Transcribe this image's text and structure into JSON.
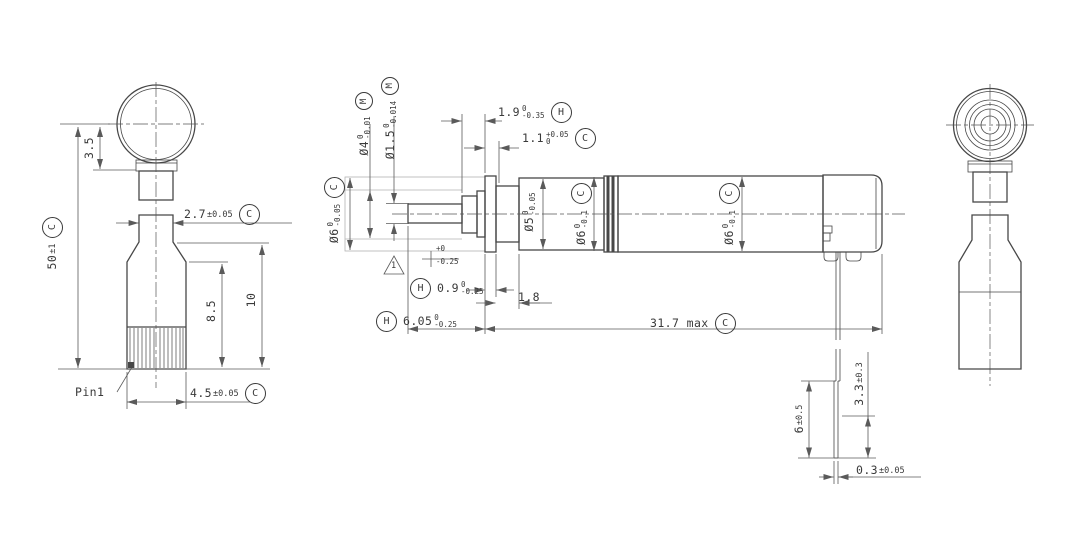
{
  "left": {
    "pin": "Pin1",
    "d35": {
      "m": "3.5"
    },
    "d50": {
      "m": "50",
      "t": "±1",
      "dt": "C"
    },
    "d27": {
      "m": "2.7",
      "t": "±0.05",
      "dt": "C"
    },
    "d85": {
      "m": "8.5"
    },
    "d10": {
      "m": "10"
    },
    "d45": {
      "m": "4.5",
      "t": "±0.05",
      "dt": "C"
    }
  },
  "front": {
    "dia6s": {
      "m": "Ø6",
      "tu": "0",
      "td": "-0.05",
      "dt": "C"
    },
    "dia4": {
      "m": "Ø4",
      "tu": "0",
      "td": "-0.01",
      "dt": "M"
    },
    "dia15": {
      "m": "Ø1.5",
      "tu": "0",
      "td": "-0.014",
      "dt": "M"
    },
    "d19": {
      "m": "1.9",
      "tu": "0",
      "td": "-0.35",
      "dt": "H"
    },
    "d11": {
      "m": "1.1",
      "tu": "+0.05",
      "td": "0",
      "dt": "C"
    },
    "dia5": {
      "m": "Ø5",
      "tu": "0",
      "td": "-0.05"
    },
    "dia6a": {
      "m": "Ø6",
      "tu": "0",
      "td": "-0.1",
      "dt": "C"
    },
    "dia6b": {
      "m": "Ø6",
      "tu": "0",
      "td": "-0.1",
      "dt": "C"
    },
    "d09": {
      "m": "0.9",
      "tu": "0",
      "td": "-0.25",
      "dt": "H"
    },
    "callout": {
      "tu": "+0",
      "td": "-0.25"
    },
    "flag": "1",
    "d18": {
      "m": "1.8"
    },
    "d605": {
      "m": "6.05",
      "tu": "0",
      "td": "-0.25",
      "dt": "H"
    },
    "d317": {
      "m": "31.7 max",
      "dt": "C"
    },
    "d33": {
      "m": "3.3",
      "t": "±0.3"
    },
    "d6": {
      "m": "6",
      "t": "±0.5"
    },
    "d03": {
      "m": "0.3",
      "t": "±0.05"
    }
  }
}
